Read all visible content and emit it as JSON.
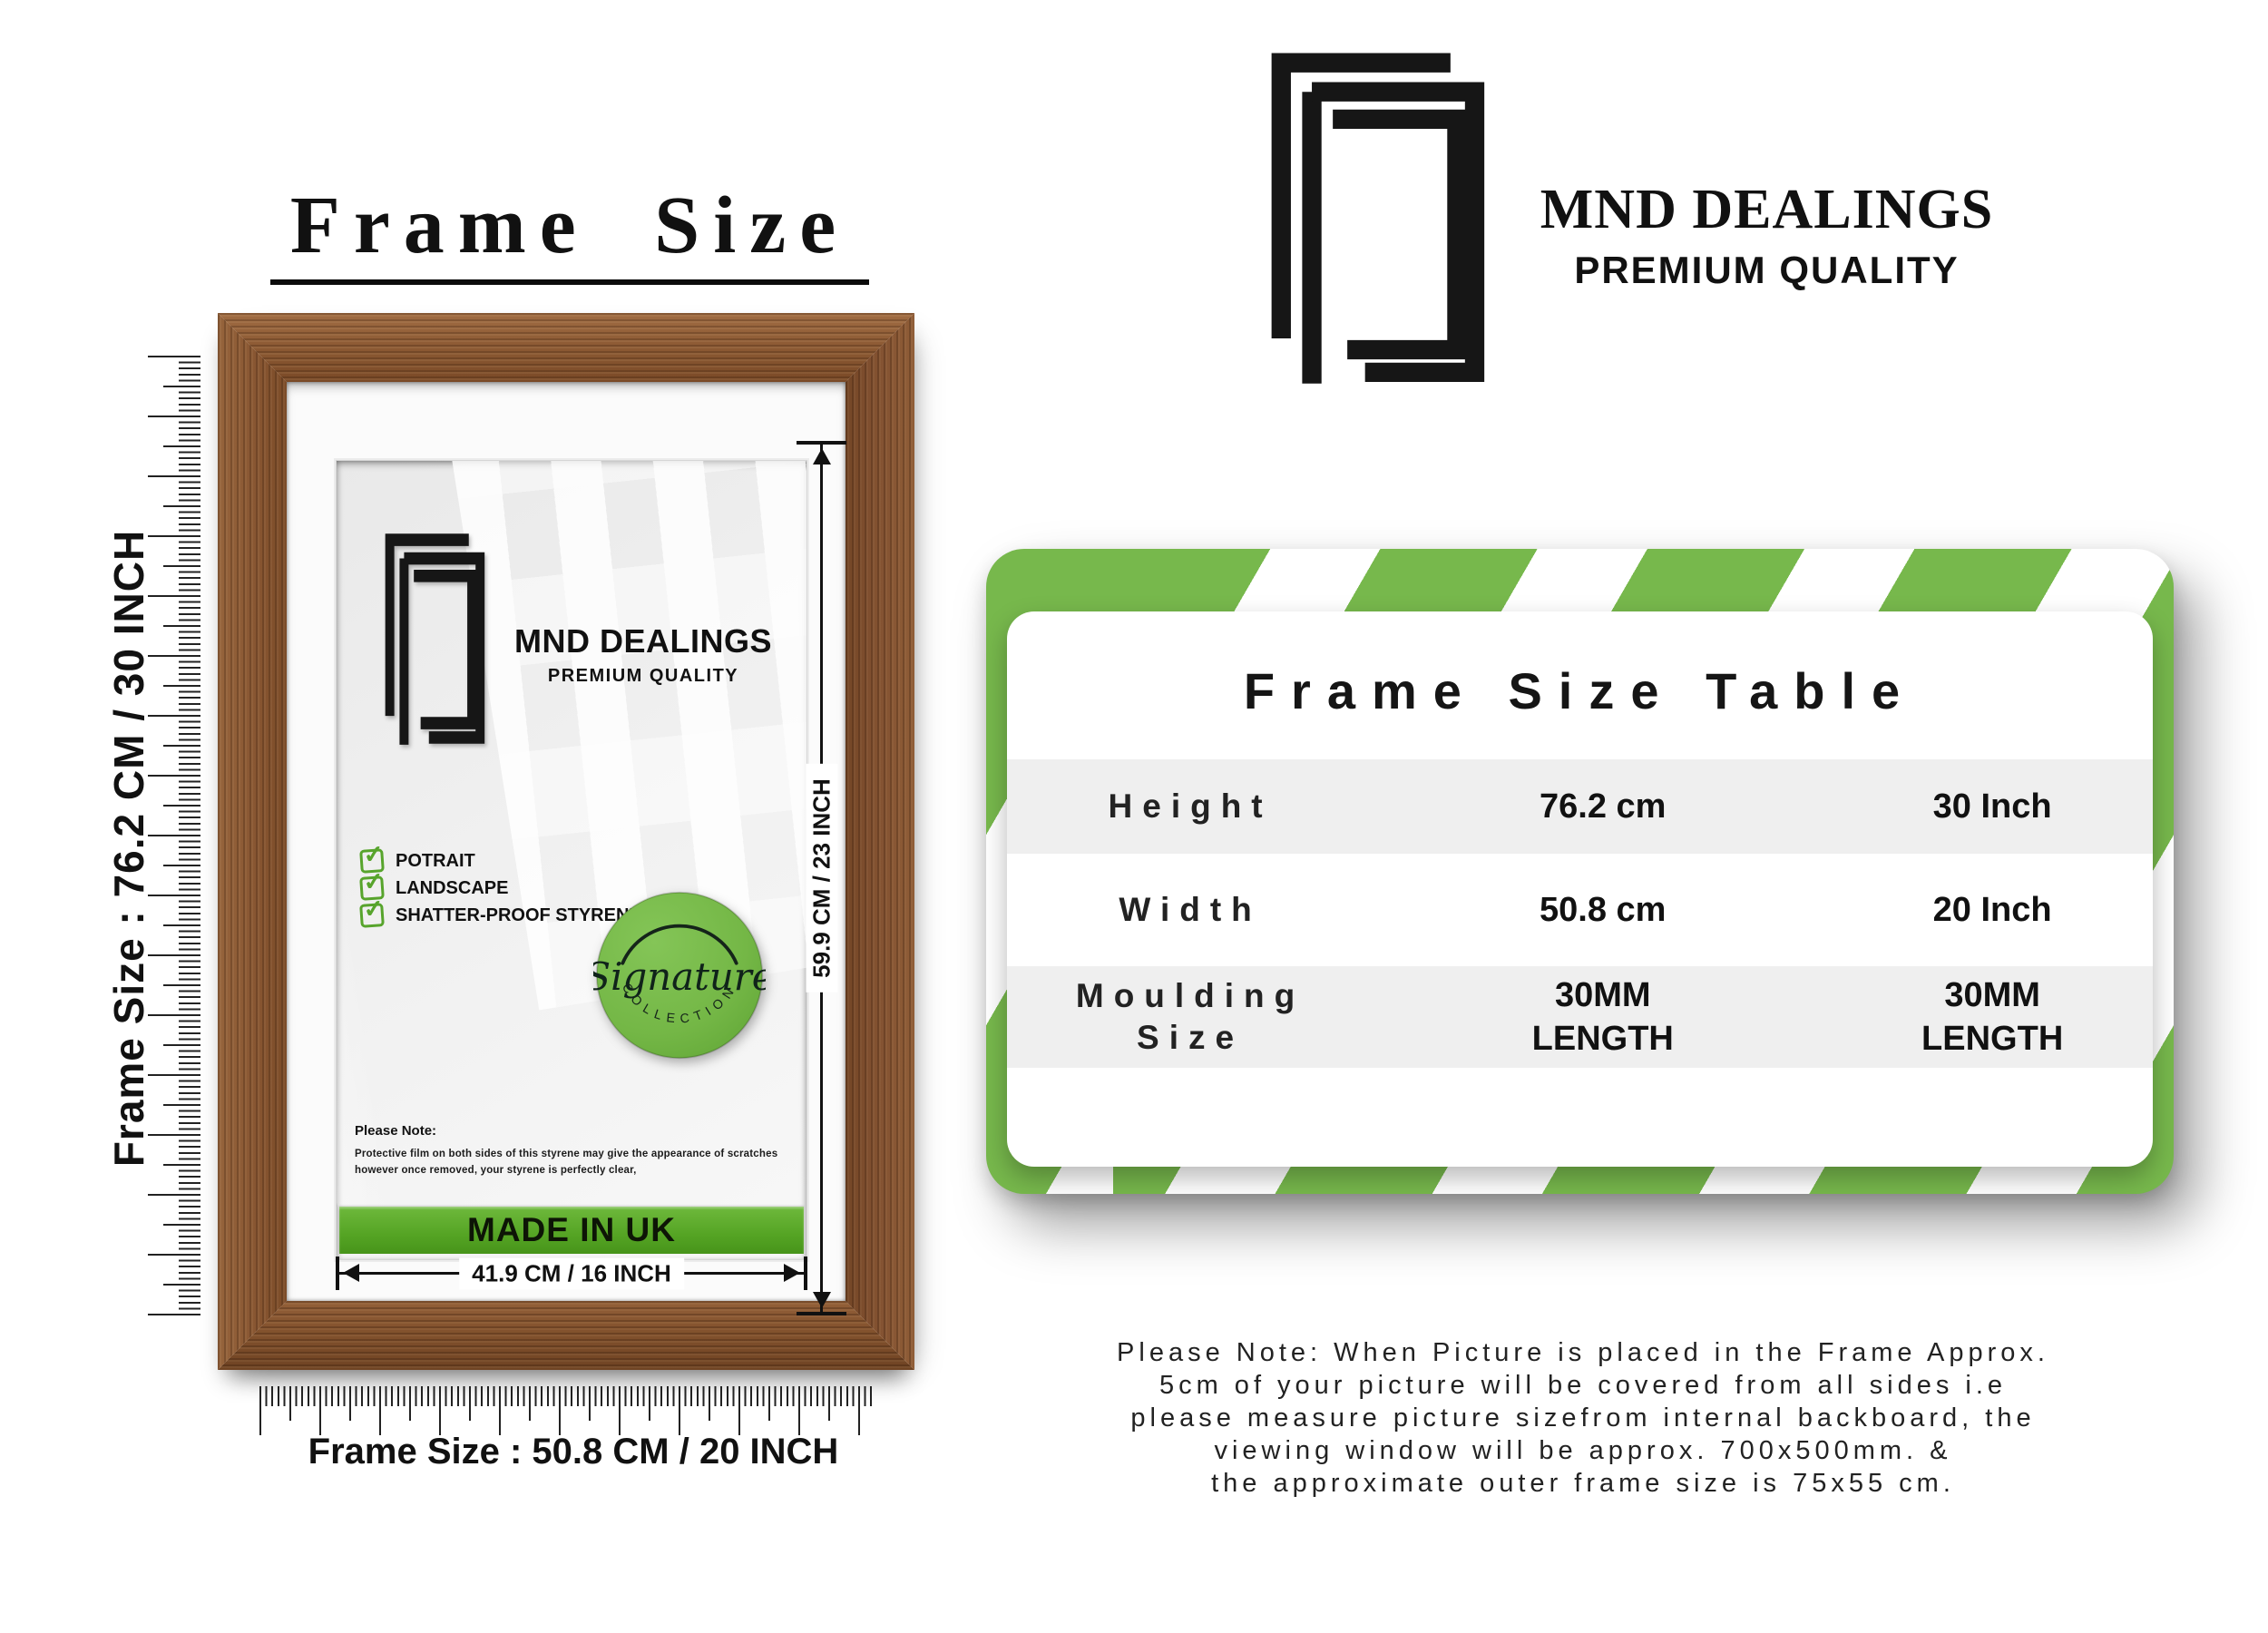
{
  "title": {
    "text": "Frame Size"
  },
  "left": {
    "ruler_side_label": "Frame Size : 76.2 CM / 30 INCH",
    "ruler_bottom_label": "Frame Size : 50.8 CM / 20 INCH",
    "frame": {
      "brand": "MND DEALINGS",
      "brand_sub": "PREMIUM QUALITY",
      "features": [
        {
          "label": "POTRAIT"
        },
        {
          "label": "LANDSCAPE"
        },
        {
          "label": "SHATTER-PROOF STYRENE"
        }
      ],
      "badge": {
        "script": "Signature",
        "arc": "COLLECTION"
      },
      "note_heading": "Please Note:",
      "note_body": "Protective film on both sides of this styrene may give the appearance of scratches however once removed, your styrene is perfectly clear,",
      "made_in": "MADE IN UK",
      "inner_height": "59.9 CM / 23 INCH",
      "inner_width": "41.9 CM / 16 INCH"
    }
  },
  "right": {
    "logo": {
      "brand": "MND DEALINGS",
      "sub": "PREMIUM QUALITY"
    },
    "table": {
      "title": "Frame Size Table",
      "rows": [
        {
          "label": "Height",
          "cm": "76.2 cm",
          "inch": "30 Inch"
        },
        {
          "label": "Width",
          "cm": "50.8 cm",
          "inch": "20 Inch"
        },
        {
          "label": "Moulding\nSize",
          "cm": "30MM\nLENGTH",
          "inch": "30MM\nLENGTH"
        }
      ]
    },
    "note_lines": [
      "Please Note: When Picture is placed in the Frame Approx.",
      "5cm of your picture will be covered from all sides i.e",
      "please measure picture sizefrom internal backboard, the",
      "viewing window will be approx. 700x500mm. &",
      "the approximate outer frame size is 75x55 cm."
    ]
  },
  "colors": {
    "accent_green": "#77b84c",
    "made_in_green_dark": "#47941a",
    "checkbox_green": "#57a42c",
    "wood_brown": "#8a5832",
    "ink": "#111111"
  }
}
